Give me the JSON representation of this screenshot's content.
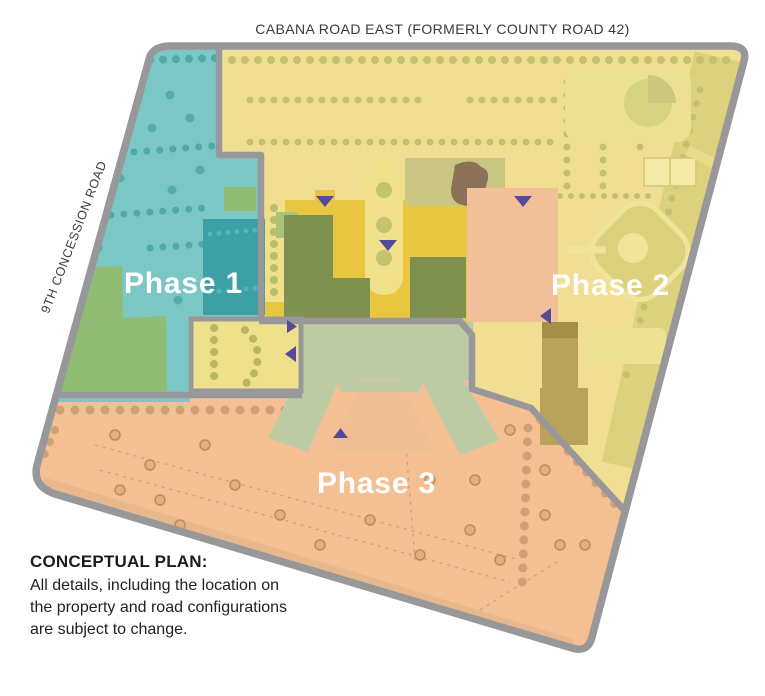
{
  "plan": {
    "roads": {
      "top": "CABANA ROAD EAST (FORMERLY COUNTY ROAD 42)",
      "left": "9TH CONCESSION ROAD"
    },
    "phases": [
      {
        "id": "phase-1",
        "label": "Phase 1",
        "color": "#7BC7C5"
      },
      {
        "id": "phase-2",
        "label": "Phase 2",
        "color": "#F0DF92"
      },
      {
        "id": "phase-3",
        "label": "Phase 3",
        "color": "#F5BF94"
      }
    ],
    "note": {
      "title": "CONCEPTUAL PLAN:",
      "lines": [
        "All details, including the location on",
        "the property and road configurations",
        "are subject to change."
      ]
    },
    "colors": {
      "boundary": "#98989A",
      "marker": "#56489A",
      "gold_strip": "#E9C640",
      "school": "#BDCBA4",
      "teal_building": "#3DA0A6",
      "green_building": "#8FBC72",
      "olive_building": "#7E9150",
      "khaki_building": "#B9A35B",
      "peach_building": "#F2C098",
      "brown_feature": "#8A7157"
    }
  }
}
